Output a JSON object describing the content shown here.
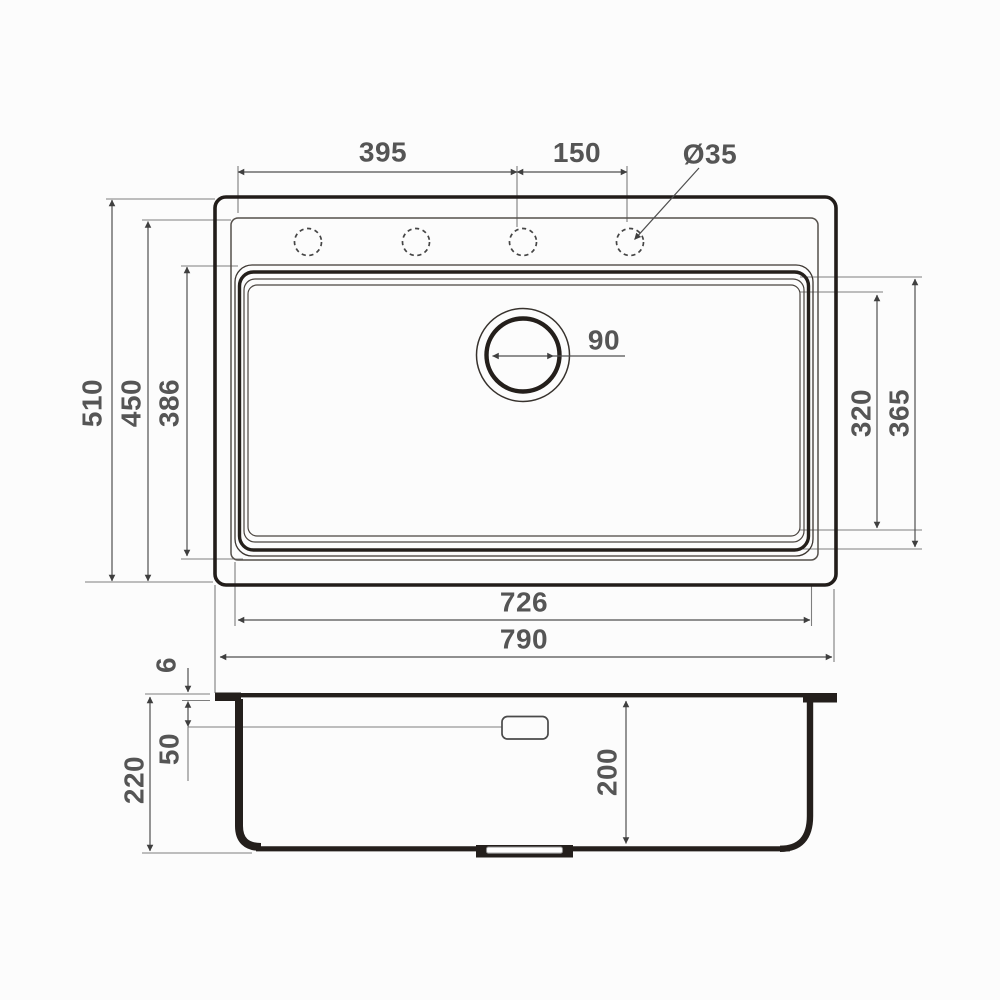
{
  "drawing": {
    "type": "technical-drawing",
    "subject": "kitchen sink dimensional diagram, top view and section view",
    "units": "mm",
    "views": [
      "top-view",
      "section-view"
    ],
    "labels": {
      "faucet_holes_span": "395",
      "faucet_hole_spacing": "150",
      "faucet_hole_diameter": "Ø35",
      "drain_diameter": "90",
      "overall_depth": "510",
      "inner_depth": "450",
      "bowl_depth": "386",
      "bowl_flat_span": "320",
      "bowl_outer_span": "365",
      "bowl_width": "726",
      "overall_width": "790",
      "rim_height": "6",
      "overflow_offset": "50",
      "overall_height": "220",
      "bowl_inner_depth": "200"
    },
    "colors": {
      "background": "#fcfcfc",
      "outline_thick": "#221d1a",
      "outline_thin": "#55504b",
      "dimension_line": "#4f4f4f",
      "extension_line": "#7e7e7e",
      "label_text": "#555555"
    }
  }
}
